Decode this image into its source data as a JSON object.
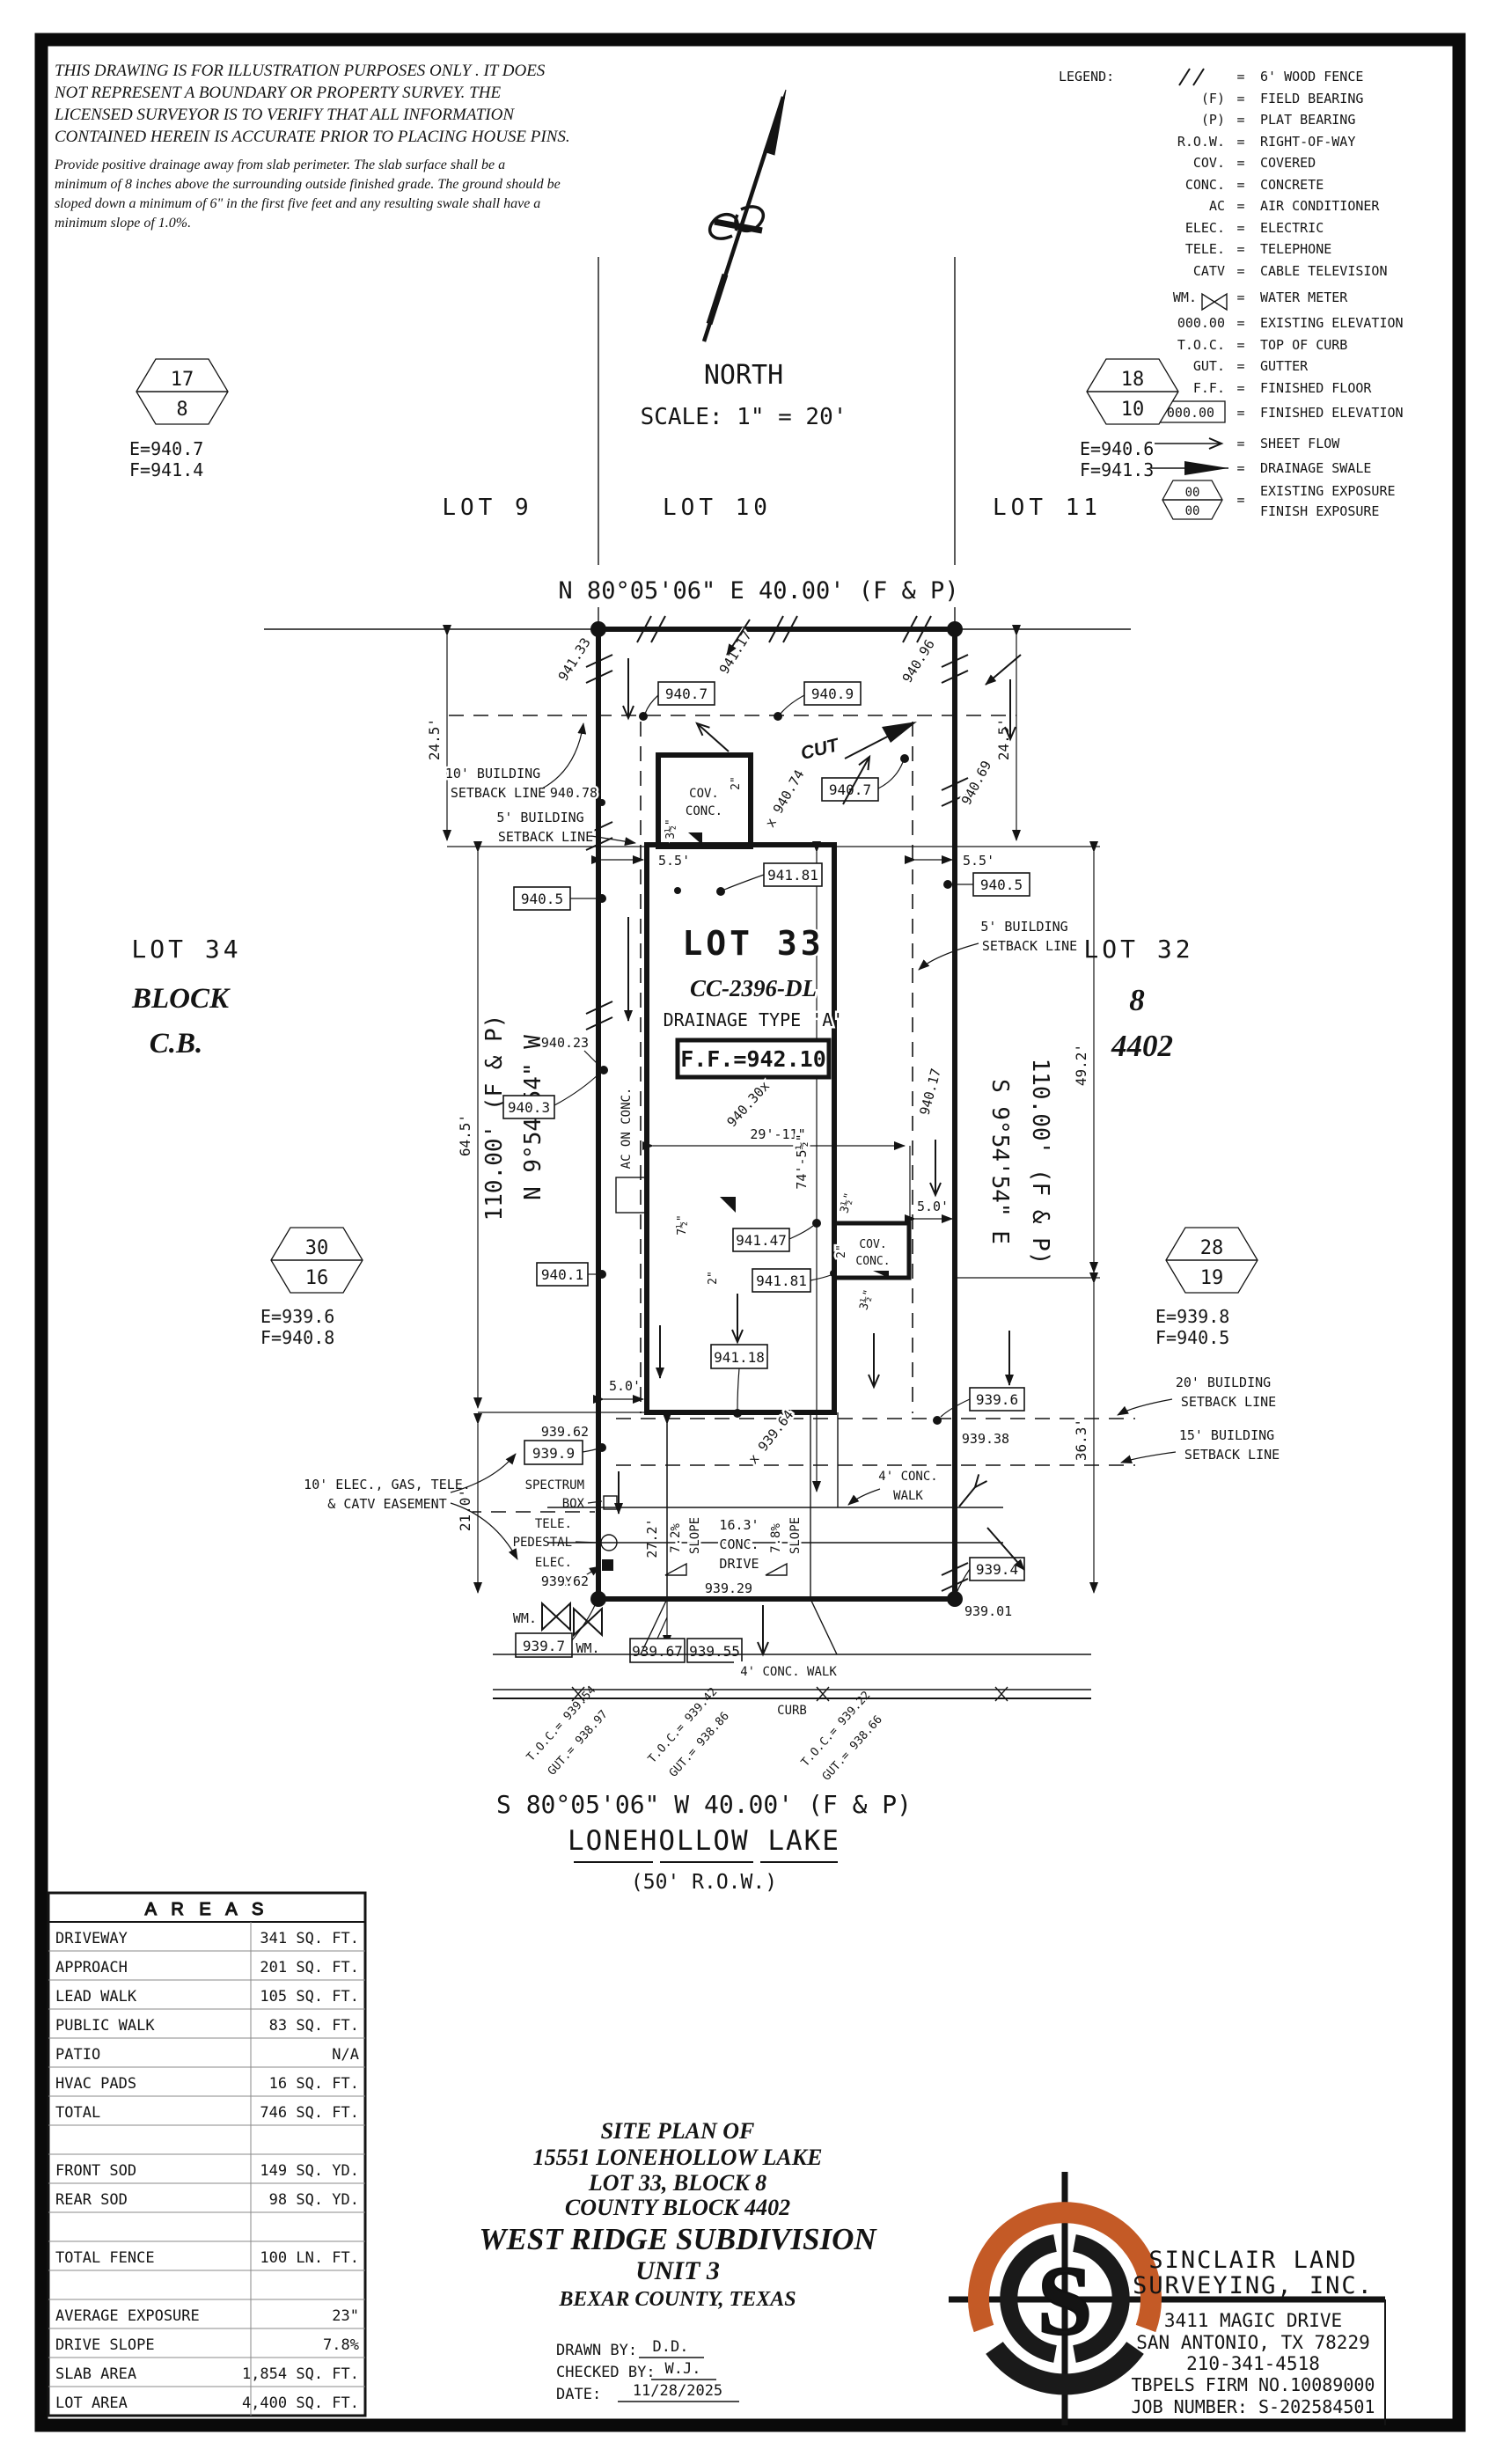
{
  "disclaimer": {
    "l1": "THIS DRAWING IS FOR ILLUSTRATION PURPOSES ONLY . IT DOES",
    "l2": "NOT REPRESENT A BOUNDARY OR PROPERTY SURVEY. THE",
    "l3": "LICENSED SURVEYOR IS TO VERIFY THAT ALL INFORMATION",
    "l4": "CONTAINED HEREIN IS ACCURATE PRIOR TO PLACING HOUSE PINS.",
    "n1": "Provide positive drainage away from slab perimeter. The slab surface shall be a",
    "n2": "minimum of 8 inches above the surrounding outside finished grade. The ground should be",
    "n3": "sloped down a minimum of 6\" in the first five feet and any resulting swale shall have a",
    "n4": "minimum slope of 1.0%."
  },
  "north": {
    "label": "NORTH",
    "scale": "SCALE: 1\" = 20'"
  },
  "legend": {
    "title": "LEGEND:",
    "eq": "=",
    "rows": [
      {
        "key": "",
        "desc": "6' WOOD FENCE"
      },
      {
        "key": "(F)",
        "desc": "FIELD BEARING"
      },
      {
        "key": "(P)",
        "desc": "PLAT BEARING"
      },
      {
        "key": "R.O.W.",
        "desc": "RIGHT-OF-WAY"
      },
      {
        "key": "COV.",
        "desc": "COVERED"
      },
      {
        "key": "CONC.",
        "desc": "CONCRETE"
      },
      {
        "key": "AC",
        "desc": "AIR CONDITIONER"
      },
      {
        "key": "ELEC.",
        "desc": "ELECTRIC"
      },
      {
        "key": "TELE.",
        "desc": "TELEPHONE"
      },
      {
        "key": "CATV",
        "desc": "CABLE TELEVISION"
      },
      {
        "key": "WM.",
        "desc": "WATER METER"
      },
      {
        "key": "000.00",
        "desc": "EXISTING ELEVATION"
      },
      {
        "key": "T.O.C.",
        "desc": "TOP OF CURB"
      },
      {
        "key": "GUT.",
        "desc": "GUTTER"
      },
      {
        "key": "F.F.",
        "desc": "FINISHED FLOOR"
      },
      {
        "key": "000.00",
        "desc": "FINISHED ELEVATION"
      },
      {
        "key": "",
        "desc": "SHEET FLOW"
      },
      {
        "key": "",
        "desc": "DRAINAGE SWALE"
      }
    ],
    "hex": {
      "top": "00",
      "bot": "00",
      "desc1": "EXISTING EXPOSURE",
      "desc2": "FINISH EXPOSURE"
    }
  },
  "plat": {
    "lot9": "LOT 9",
    "lot10": "LOT 10",
    "lot11": "LOT 11",
    "bearing_top": "N 80°05'06\" E 40.00' (F & P)",
    "bearing_bottom": "S 80°05'06\" W 40.00' (F & P)",
    "street_name": "LONEHOLLOW LAKE",
    "row_label": "(50' R.O.W.)",
    "left_bearing1": "N 9°54'54\" W",
    "left_bearing2": "110.00' (F & P)",
    "right_bearing1": "S 9°54'54\" E",
    "right_bearing2": "110.00' (F & P)",
    "lot34": "LOT 34",
    "block_w": "BLOCK",
    "cb": "C.B.",
    "lot32": "LOT 32",
    "block8": "8",
    "cb4402": "4402",
    "lot33": "LOT 33",
    "cc": "CC-2396-DL",
    "drainage": "DRAINAGE TYPE 'A'",
    "ff": "F.F.=942.10",
    "cut": "CUT",
    "cov": "COV.",
    "conc": "CONC.",
    "ac_on_conc": "AC ON CONC.",
    "bsl10": "10' BUILDING",
    "bsl5": "5' BUILDING",
    "bsl20": "20' BUILDING",
    "bsl15": "15' BUILDING",
    "sbl": "SETBACK LINE",
    "easement1": "10' ELEC., GAS, TELE.",
    "easement2": "& CATV EASEMENT",
    "spectrum": "SPECTRUM",
    "box": "BOX",
    "tele": "TELE.",
    "pedestal": "PEDESTAL",
    "elec": "ELEC.",
    "wm": "WM.",
    "walk4": "4' CONC. WALK",
    "walk4a": "4' CONC.",
    "walk4b": "WALK",
    "curb": "CURB",
    "drive1": "16.3'",
    "drive2": "CONC.",
    "drive3": "DRIVE",
    "slope72": "7.2%",
    "slope78": "7.8%",
    "slope": "SLOPE",
    "dims": {
      "d245": "24.5'",
      "d55": "5.5'",
      "d492": "49.2'",
      "d363": "36.3'",
      "d645": "64.5'",
      "d210": "21.0'",
      "d272": "27.2'",
      "d2911": "29'-11\"",
      "d745": "74'-5½\"",
      "d50": "5.0'",
      "d2in": "2\"",
      "d35in": "3½\"",
      "d75in": "7½\""
    },
    "elev": {
      "e94133": "941.33",
      "e94117": "941.17",
      "e94096": "940.96",
      "e94078": "940.78",
      "e9407": "940.7",
      "e9409": "940.9",
      "e94074": "x 940.74",
      "e94069": "940.69",
      "e9405": "940.5",
      "e94181": "941.81",
      "e94023": "940.23",
      "e9403": "940.3",
      "e94030": "940.30x",
      "e94017": "940.17",
      "e9401": "940.1",
      "e94147": "941.47",
      "e94118": "941.18",
      "e93962": "939.62",
      "e9399": "939.9",
      "e9396": "939.6",
      "e93938": "939.38",
      "e93964": "x 939.64",
      "e9394": "939.4",
      "e93901": "939.01",
      "e9397": "939.7",
      "e93929": "939.29",
      "e93967": "939.67",
      "e93955": "939.55"
    },
    "toc": {
      "t1a": "T.O.C.= 939.54",
      "t1b": "GUT.= 938.97",
      "t2a": "T.O.C.= 939.42",
      "t2b": "GUT.= 938.86",
      "t3a": "T.O.C.= 939.22",
      "t3b": "GUT.= 938.66"
    },
    "bm": {
      "b1t": "17",
      "b1b": "8",
      "b1e": "E=940.7",
      "b1f": "F=941.4",
      "b2t": "18",
      "b2b": "10",
      "b2e": "E=940.6",
      "b2f": "F=941.3",
      "b3t": "30",
      "b3b": "16",
      "b3e": "E=939.6",
      "b3f": "F=940.8",
      "b4t": "28",
      "b4b": "19",
      "b4e": "E=939.8",
      "b4f": "F=940.5"
    }
  },
  "table": {
    "title": "A R E A S",
    "rows": [
      {
        "l": "DRIVEWAY",
        "v": "341 SQ. FT."
      },
      {
        "l": "APPROACH",
        "v": "201 SQ. FT."
      },
      {
        "l": "LEAD WALK",
        "v": "105 SQ. FT."
      },
      {
        "l": "PUBLIC WALK",
        "v": "83 SQ. FT."
      },
      {
        "l": "PATIO",
        "v": "N/A"
      },
      {
        "l": "HVAC PADS",
        "v": "16 SQ. FT."
      },
      {
        "l": "TOTAL",
        "v": "746 SQ. FT."
      },
      {
        "l": "",
        "v": ""
      },
      {
        "l": "FRONT SOD",
        "v": "149 SQ. YD."
      },
      {
        "l": "REAR SOD",
        "v": "98 SQ. YD."
      },
      {
        "l": "",
        "v": ""
      },
      {
        "l": "TOTAL FENCE",
        "v": "100 LN. FT."
      },
      {
        "l": "",
        "v": ""
      },
      {
        "l": "AVERAGE EXPOSURE",
        "v": "23\""
      },
      {
        "l": "DRIVE SLOPE",
        "v": "7.8%"
      },
      {
        "l": "SLAB AREA",
        "v": "1,854 SQ. FT."
      },
      {
        "l": "LOT AREA",
        "v": "4,400 SQ. FT."
      },
      {
        "l": "",
        "v": ""
      }
    ]
  },
  "titleblock": {
    "t1": "SITE PLAN OF",
    "t2": "15551 LONEHOLLOW LAKE",
    "t3": "LOT 33, BLOCK 8",
    "t4": "COUNTY BLOCK 4402",
    "t5": "WEST RIDGE SUBDIVISION",
    "t6": "UNIT 3",
    "t7": "BEXAR COUNTY, TEXAS",
    "drawn_label": "DRAWN BY:",
    "drawn": "D.D.",
    "checked_label": "CHECKED BY:",
    "checked": "W.J.",
    "date_label": "DATE:",
    "date": "11/28/2025"
  },
  "firm": {
    "name1": "SINCLAIR LAND",
    "name2": "SURVEYING, INC.",
    "addr1": "3411 MAGIC DRIVE",
    "addr2": "SAN ANTONIO, TX 78229",
    "phone": "210-341-4518",
    "firm_no": "TBPELS FIRM NO.10089000",
    "job": "JOB NUMBER: S-202584501",
    "brand": "#c45a26",
    "logo_s": "S"
  }
}
